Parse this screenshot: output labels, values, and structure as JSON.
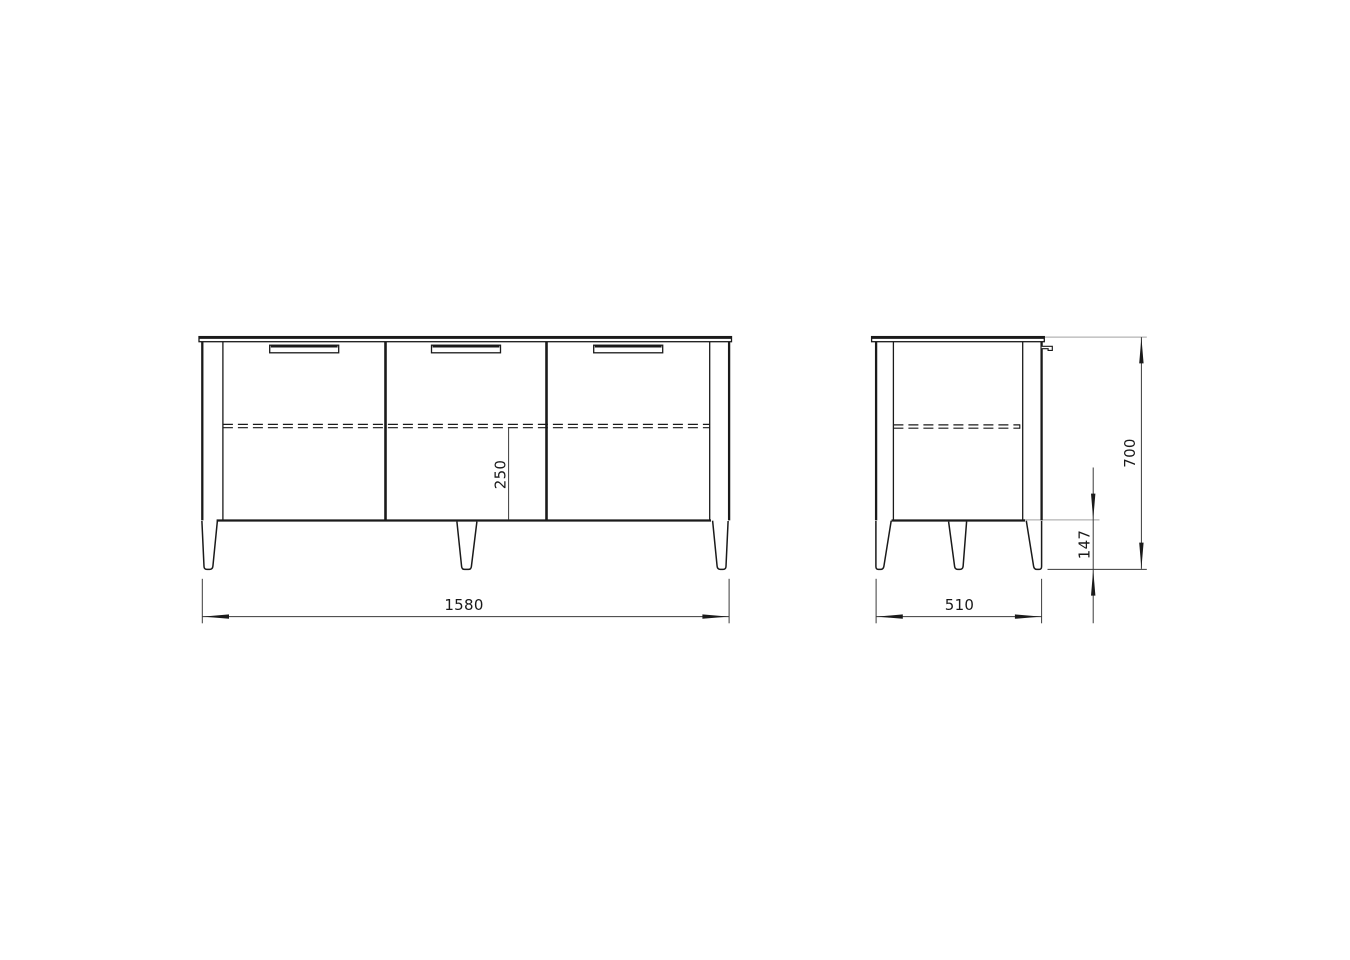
{
  "drawing": {
    "type": "furniture-dimension-diagram",
    "views": {
      "front": {
        "label": "front-view",
        "dimensions": {
          "overall_width_mm": "1580",
          "shelf_to_bottom_mm": "250"
        }
      },
      "side": {
        "label": "side-view",
        "dimensions": {
          "overall_depth_mm": "510",
          "leg_height_mm": "147",
          "overall_height_mm": "700"
        }
      }
    },
    "colors": {
      "outline": "#1a1a1a",
      "dimension_line": "#3a3a3a",
      "extension_gray": "#b4b4b4",
      "background": "#ffffff"
    }
  }
}
